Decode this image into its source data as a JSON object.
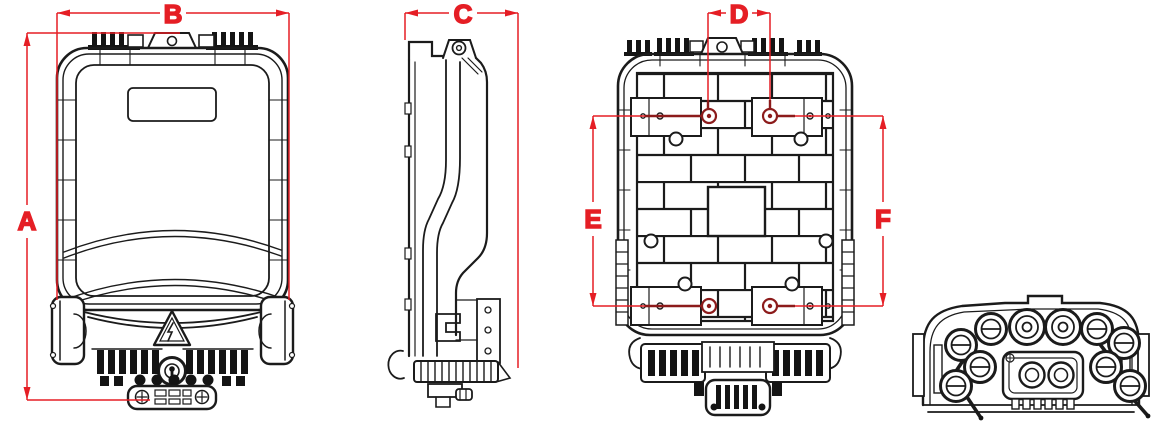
{
  "drawing": {
    "type": "technical-drawing",
    "subject": "fiber-optic-distribution-box-four-views",
    "background_color": "#ffffff",
    "line_color": "#1b1b1b",
    "dimension_color": "#e51e25",
    "hole_accent_color": "#8c1b1b"
  },
  "dimensions": {
    "a": "A",
    "b": "B",
    "c": "C",
    "d": "D",
    "e": "E",
    "f": "F"
  }
}
